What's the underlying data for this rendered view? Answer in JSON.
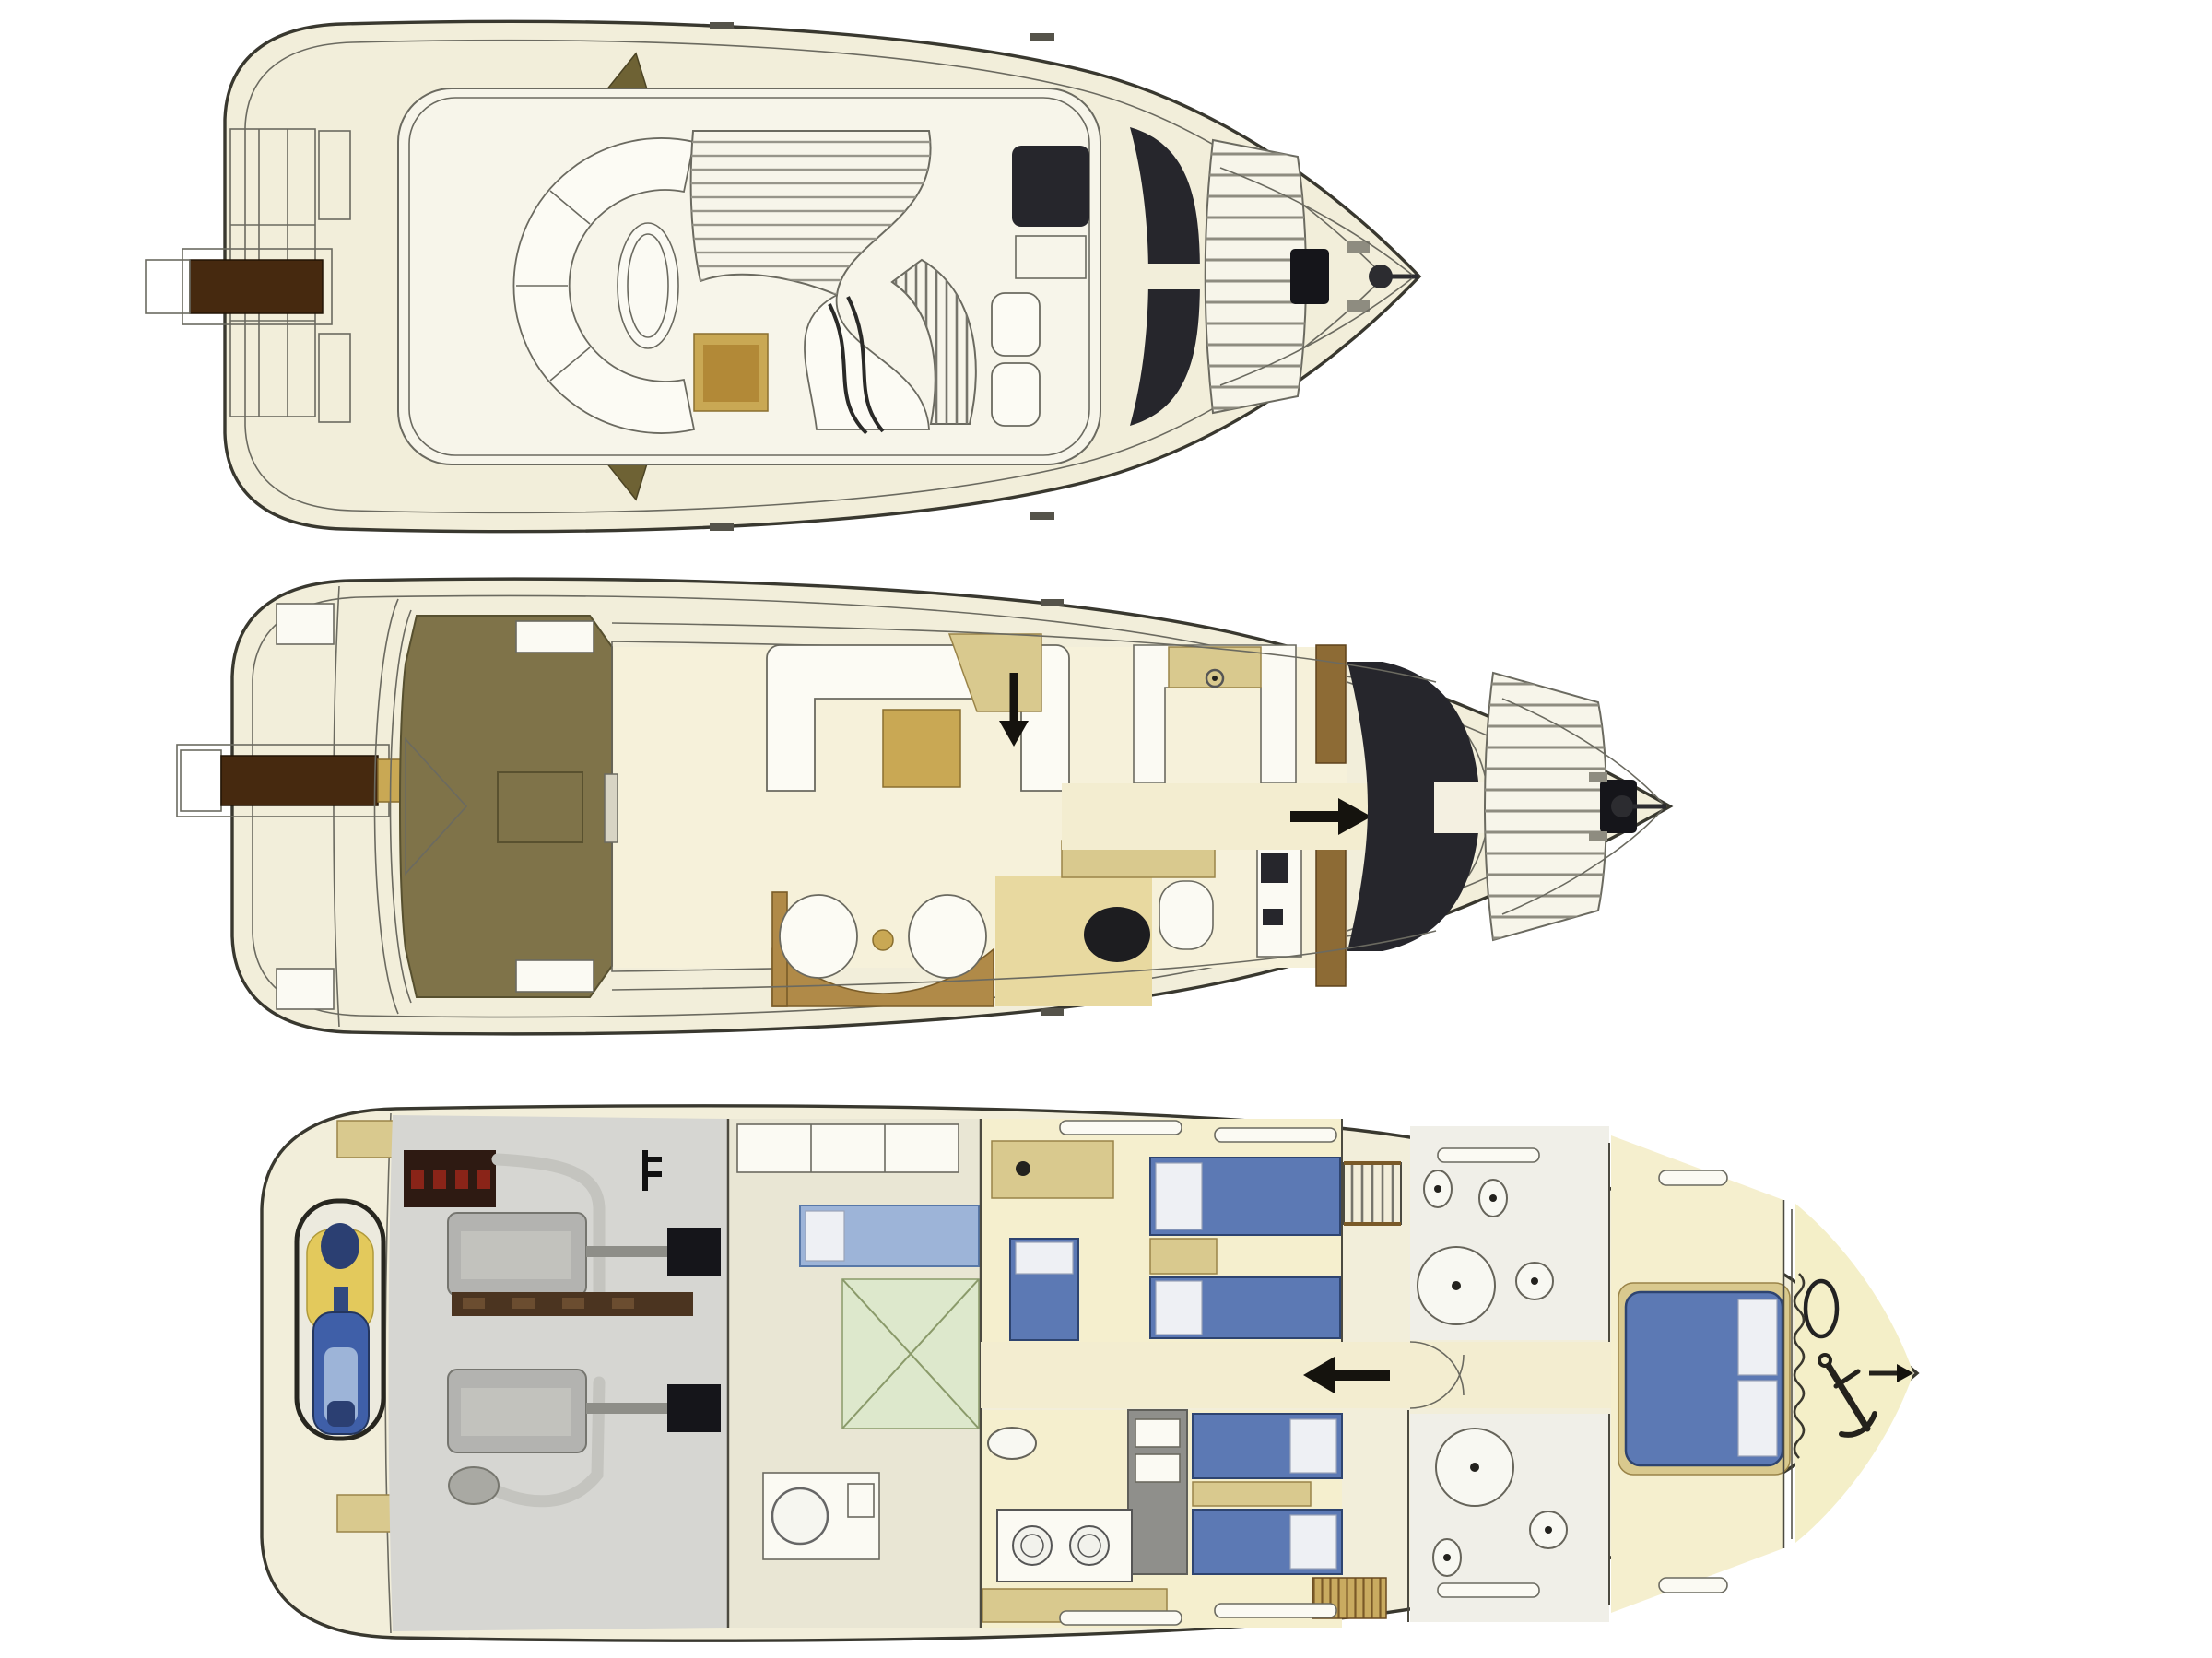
{
  "title": "Motor yacht three-deck floor plan (flybridge, main deck, lower deck)",
  "colors": {
    "background": "#ffffff",
    "hull_fill": "#f2eeda",
    "hull_stroke": "#39382f",
    "deck_cream": "#eee9d2",
    "platform_white": "#f7f5ea",
    "cushion_white": "#fcfbf4",
    "stripe_gray": "#97958a",
    "teak_olive": "#7f7349",
    "teak_dark": "#6e6234",
    "passerelle_brown": "#46290f",
    "tan_gold": "#c9a854",
    "tan_light": "#d9c98e",
    "wood_brown": "#8d6b35",
    "dark_panel": "#26262c",
    "hatch_black": "#15151a",
    "engine_gray": "#b3b3b0",
    "engine_floor": "#d6d6d2",
    "rail_brown": "#4b3420",
    "bed_blue": "#5c79b4",
    "pillow_white": "#eef0f4",
    "jetski_blue": "#3f5fa8",
    "jetski_navy": "#2b3f72",
    "jetski_yellow": "#e3c95c",
    "crew_blue": "#9db4d8",
    "pale_yellow": "#f5efce",
    "pale_green": "#dde8cc",
    "battery_dark": "#2e1a12",
    "battery_red": "#8a2418",
    "bath_white": "#f0efe8",
    "line_gray": "#6b6a60",
    "salon_floor": "#f6f1da",
    "corridor_cream": "#f3edd0"
  }
}
